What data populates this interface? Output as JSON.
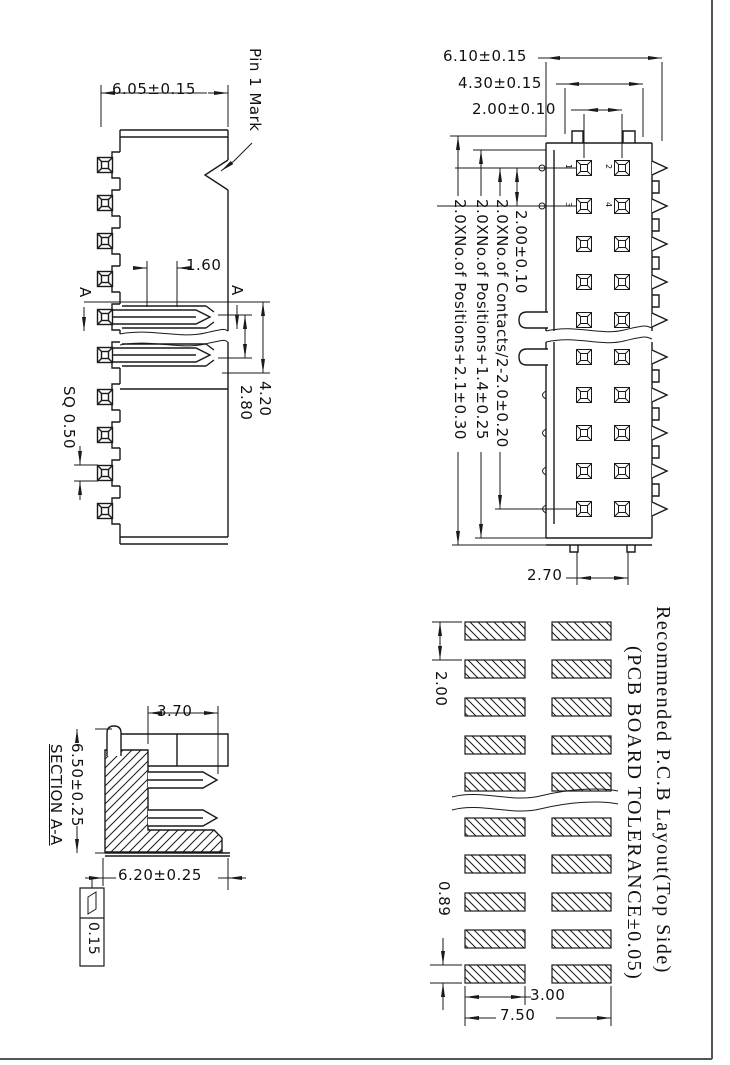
{
  "colors": {
    "line": "#1a1a1a",
    "background": "#ffffff"
  },
  "side_view": {
    "width_dim": "6.05±0.15",
    "pin1_label": "Pin 1 Mark",
    "slot_dim": "1.60",
    "height_dim": "4.20",
    "inner_height_dim": "2.80",
    "sq_dim": "SQ 0.50",
    "section_a_left": "A",
    "section_a_right": "A"
  },
  "top_view": {
    "overall_dim": "6.10±0.15",
    "shroud_dim": "4.30±0.15",
    "col_pitch_dim": "2.00±0.10",
    "row_pitch_dim": "2.00±0.10",
    "contacts_dim": "2.0XNo.of Contacts/2-2.0±0.20",
    "positions_inner_dim": "2.0XNo.of Positions+1.4±0.25",
    "positions_outer_dim": "2.0XNo.of Positions+2.1±0.30",
    "tail_dim": "2.70",
    "pins": [
      "1",
      "2",
      "3",
      "4"
    ]
  },
  "section_view": {
    "title": "SECTION A-A",
    "top_dim": "3.70",
    "height_dim": "6.50±0.25",
    "width_dim": "6.20±0.25",
    "flatness_tol": "0.15"
  },
  "pcb": {
    "title": "Recommended P.C.B Layout(Top Side)",
    "subtitle": "(PCB BOARD TOLERANCE±0.05)",
    "pitch_dim": "2.00",
    "pad_h_dim": "0.89",
    "pad_w_dim": "3.00",
    "span_dim": "7.50"
  }
}
